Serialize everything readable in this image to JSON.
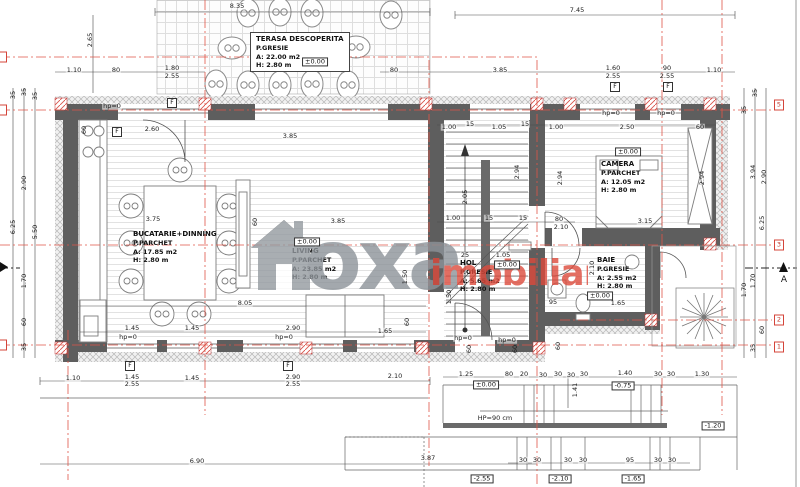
{
  "watermark": {
    "text_gray": "oxa",
    "text_red": "imobiliare",
    "gray": "#8d9399",
    "red": "#dd4a3c"
  },
  "rooms": {
    "terasa": {
      "name": "TERASA DESCOPERITA",
      "finish": "P.GRESIE",
      "area": "A: 22.00 m2",
      "height": "H: 2.80 m"
    },
    "bucatarie": {
      "name": "BUCATARIE+DINNING",
      "finish": "P.PARCHET",
      "area": "A: 17.85 m2",
      "height": "H: 2.80 m"
    },
    "living": {
      "name": "LIVING",
      "finish": "P.PARCHET",
      "area": "A: 23.85 m2",
      "height": "H: 2.80 m"
    },
    "hol": {
      "name": "HOL",
      "finish": "P.GRESIE",
      "area": "A: 5.65 m2",
      "height": "H: 2.80 m"
    },
    "baie": {
      "name": "BAIE",
      "finish": "P.GRESIE",
      "area": "A: 2.55 m2",
      "height": "H: 2.80 m"
    },
    "camera": {
      "name": "CAMERA",
      "finish": "P.PARCHET",
      "area": "A: 12.05 m2",
      "height": "H: 2.80 m"
    }
  },
  "annotations": {
    "f_label": "F",
    "section_label": "A",
    "grid_markers": [
      {
        "x": 779,
        "y": 105,
        "t": "5"
      },
      {
        "x": 779,
        "y": 245,
        "t": "3"
      },
      {
        "x": 779,
        "y": 320,
        "t": "2"
      },
      {
        "x": 779,
        "y": 347,
        "t": "1"
      },
      {
        "x": 2,
        "y": 57,
        "t": ""
      },
      {
        "x": 2,
        "y": 110,
        "t": ""
      },
      {
        "x": 2,
        "y": 345,
        "t": ""
      }
    ],
    "f_markers": [
      {
        "x": 172,
        "y": 103
      },
      {
        "x": 117,
        "y": 132
      },
      {
        "x": 615,
        "y": 87
      },
      {
        "x": 668,
        "y": 87
      },
      {
        "x": 130,
        "y": 366
      },
      {
        "x": 288,
        "y": 366
      }
    ],
    "levels": [
      {
        "x": 315,
        "y": 62,
        "t": "±0.00"
      },
      {
        "x": 307,
        "y": 242,
        "t": "±0.00"
      },
      {
        "x": 628,
        "y": 152,
        "t": "±0.00"
      },
      {
        "x": 507,
        "y": 265,
        "t": "±0.00"
      },
      {
        "x": 600,
        "y": 296,
        "t": "±0.00"
      },
      {
        "x": 486,
        "y": 385,
        "t": "±0.00"
      },
      {
        "x": 623,
        "y": 386,
        "t": "-0.75"
      },
      {
        "x": 713,
        "y": 426,
        "t": "-1.20"
      },
      {
        "x": 482,
        "y": 479,
        "t": "-2.55"
      },
      {
        "x": 560,
        "y": 479,
        "t": "-2.10"
      },
      {
        "x": 633,
        "y": 479,
        "t": "-1.65"
      }
    ],
    "dimensions": [
      {
        "x": 237,
        "y": 6,
        "t": "8.35"
      },
      {
        "x": 577,
        "y": 10,
        "t": "7.45"
      },
      {
        "x": 90,
        "y": 40,
        "t": "2.65",
        "r": 1
      },
      {
        "x": 74,
        "y": 70,
        "t": "1.10"
      },
      {
        "x": 116,
        "y": 70,
        "t": "80"
      },
      {
        "x": 172,
        "y": 68,
        "t": "1.80"
      },
      {
        "x": 172,
        "y": 76,
        "t": "2.55"
      },
      {
        "x": 394,
        "y": 70,
        "t": "80"
      },
      {
        "x": 500,
        "y": 70,
        "t": "3.85"
      },
      {
        "x": 613,
        "y": 68,
        "t": "1.60"
      },
      {
        "x": 613,
        "y": 76,
        "t": "2.55"
      },
      {
        "x": 667,
        "y": 68,
        "t": "90"
      },
      {
        "x": 667,
        "y": 76,
        "t": "2.55"
      },
      {
        "x": 714,
        "y": 70,
        "t": "1.10"
      },
      {
        "x": 152,
        "y": 129,
        "t": "2.60"
      },
      {
        "x": 290,
        "y": 136,
        "t": "3.85"
      },
      {
        "x": 84,
        "y": 130,
        "t": "60",
        "r": 1
      },
      {
        "x": 449,
        "y": 127,
        "t": "1.00"
      },
      {
        "x": 470,
        "y": 124,
        "t": "15"
      },
      {
        "x": 499,
        "y": 127,
        "t": "1.05"
      },
      {
        "x": 525,
        "y": 124,
        "t": "15"
      },
      {
        "x": 556,
        "y": 127,
        "t": "1.00"
      },
      {
        "x": 627,
        "y": 127,
        "t": "2.50"
      },
      {
        "x": 700,
        "y": 127,
        "t": "60"
      },
      {
        "x": 112,
        "y": 106,
        "t": "hp=0"
      },
      {
        "x": 611,
        "y": 113,
        "t": "hp=0"
      },
      {
        "x": 666,
        "y": 113,
        "t": "hp=0"
      },
      {
        "x": 465,
        "y": 197,
        "t": "2.05",
        "r": 1
      },
      {
        "x": 517,
        "y": 172,
        "t": "2.94",
        "r": 1
      },
      {
        "x": 560,
        "y": 178,
        "t": "2.94",
        "r": 1
      },
      {
        "x": 702,
        "y": 178,
        "t": "2.94",
        "r": 1
      },
      {
        "x": 338,
        "y": 221,
        "t": "3.85"
      },
      {
        "x": 405,
        "y": 277,
        "t": "1.50",
        "r": 1
      },
      {
        "x": 255,
        "y": 222,
        "t": "60",
        "r": 1
      },
      {
        "x": 153,
        "y": 219,
        "t": "3.75"
      },
      {
        "x": 453,
        "y": 218,
        "t": "1.00"
      },
      {
        "x": 489,
        "y": 218,
        "t": "15"
      },
      {
        "x": 523,
        "y": 218,
        "t": "15"
      },
      {
        "x": 559,
        "y": 219,
        "t": "80"
      },
      {
        "x": 561,
        "y": 227,
        "t": "2.10"
      },
      {
        "x": 645,
        "y": 221,
        "t": "3.15"
      },
      {
        "x": 465,
        "y": 255,
        "t": "25"
      },
      {
        "x": 503,
        "y": 255,
        "t": "1.05"
      },
      {
        "x": 449,
        "y": 297,
        "t": "1.50",
        "r": 1
      },
      {
        "x": 592,
        "y": 268,
        "t": "2.10",
        "r": 1
      },
      {
        "x": 618,
        "y": 303,
        "t": "1.65"
      },
      {
        "x": 553,
        "y": 302,
        "t": "95"
      },
      {
        "x": 245,
        "y": 303,
        "t": "8.05"
      },
      {
        "x": 132,
        "y": 328,
        "t": "1.45"
      },
      {
        "x": 192,
        "y": 328,
        "t": "1.45"
      },
      {
        "x": 293,
        "y": 328,
        "t": "2.90"
      },
      {
        "x": 385,
        "y": 331,
        "t": "1.65"
      },
      {
        "x": 407,
        "y": 322,
        "t": "60",
        "r": 1
      },
      {
        "x": 128,
        "y": 337,
        "t": "hp=0"
      },
      {
        "x": 284,
        "y": 337,
        "t": "hp=0"
      },
      {
        "x": 463,
        "y": 338,
        "t": "hp=0"
      },
      {
        "x": 507,
        "y": 340,
        "t": "hp=0"
      },
      {
        "x": 469,
        "y": 349,
        "t": "60",
        "r": 1
      },
      {
        "x": 515,
        "y": 349,
        "t": "60",
        "r": 1
      },
      {
        "x": 558,
        "y": 346,
        "t": "60",
        "r": 1
      },
      {
        "x": 13,
        "y": 95,
        "t": "35",
        "r": 1
      },
      {
        "x": 24,
        "y": 92,
        "t": "35",
        "r": 1
      },
      {
        "x": 35,
        "y": 96,
        "t": "35",
        "r": 1
      },
      {
        "x": 24,
        "y": 183,
        "t": "2.90",
        "r": 1
      },
      {
        "x": 13,
        "y": 227,
        "t": "6.25",
        "r": 1
      },
      {
        "x": 35,
        "y": 232,
        "t": "5.50",
        "r": 1
      },
      {
        "x": 24,
        "y": 281,
        "t": "1.70",
        "r": 1
      },
      {
        "x": 24,
        "y": 322,
        "t": "60",
        "r": 1
      },
      {
        "x": 24,
        "y": 347,
        "t": "35",
        "r": 1
      },
      {
        "x": 755,
        "y": 93,
        "t": "35",
        "r": 1
      },
      {
        "x": 744,
        "y": 110,
        "t": "35",
        "r": 1
      },
      {
        "x": 753,
        "y": 172,
        "t": "3.94",
        "r": 1
      },
      {
        "x": 764,
        "y": 177,
        "t": "2.90",
        "r": 1
      },
      {
        "x": 762,
        "y": 223,
        "t": "6.25",
        "r": 1
      },
      {
        "x": 753,
        "y": 281,
        "t": "1.70",
        "r": 1
      },
      {
        "x": 744,
        "y": 290,
        "t": "1.70",
        "r": 1
      },
      {
        "x": 762,
        "y": 330,
        "t": "60",
        "r": 1
      },
      {
        "x": 753,
        "y": 348,
        "t": "35",
        "r": 1
      },
      {
        "x": 73,
        "y": 378,
        "t": "1.10"
      },
      {
        "x": 132,
        "y": 377,
        "t": "1.45"
      },
      {
        "x": 132,
        "y": 384,
        "t": "2.55"
      },
      {
        "x": 192,
        "y": 378,
        "t": "1.45"
      },
      {
        "x": 293,
        "y": 377,
        "t": "2.90"
      },
      {
        "x": 293,
        "y": 384,
        "t": "2.55"
      },
      {
        "x": 395,
        "y": 376,
        "t": "2.10"
      },
      {
        "x": 466,
        "y": 374,
        "t": "1.25"
      },
      {
        "x": 509,
        "y": 374,
        "t": "80"
      },
      {
        "x": 524,
        "y": 374,
        "t": "20"
      },
      {
        "x": 543,
        "y": 375,
        "t": "30"
      },
      {
        "x": 558,
        "y": 374,
        "t": "30"
      },
      {
        "x": 571,
        "y": 375,
        "t": "30"
      },
      {
        "x": 584,
        "y": 374,
        "t": "30"
      },
      {
        "x": 625,
        "y": 373,
        "t": "1.40"
      },
      {
        "x": 658,
        "y": 374,
        "t": "30"
      },
      {
        "x": 671,
        "y": 374,
        "t": "30"
      },
      {
        "x": 702,
        "y": 374,
        "t": "1.30"
      },
      {
        "x": 495,
        "y": 418,
        "t": "HP=90 cm"
      },
      {
        "x": 575,
        "y": 390,
        "t": "1.41",
        "r": 1
      },
      {
        "x": 428,
        "y": 458,
        "t": "3.87"
      },
      {
        "x": 523,
        "y": 460,
        "t": "30"
      },
      {
        "x": 537,
        "y": 460,
        "t": "30"
      },
      {
        "x": 568,
        "y": 460,
        "t": "30"
      },
      {
        "x": 583,
        "y": 460,
        "t": "30"
      },
      {
        "x": 630,
        "y": 460,
        "t": "95"
      },
      {
        "x": 658,
        "y": 460,
        "t": "30"
      },
      {
        "x": 672,
        "y": 460,
        "t": "30"
      },
      {
        "x": 197,
        "y": 461,
        "t": "6.90"
      }
    ]
  }
}
